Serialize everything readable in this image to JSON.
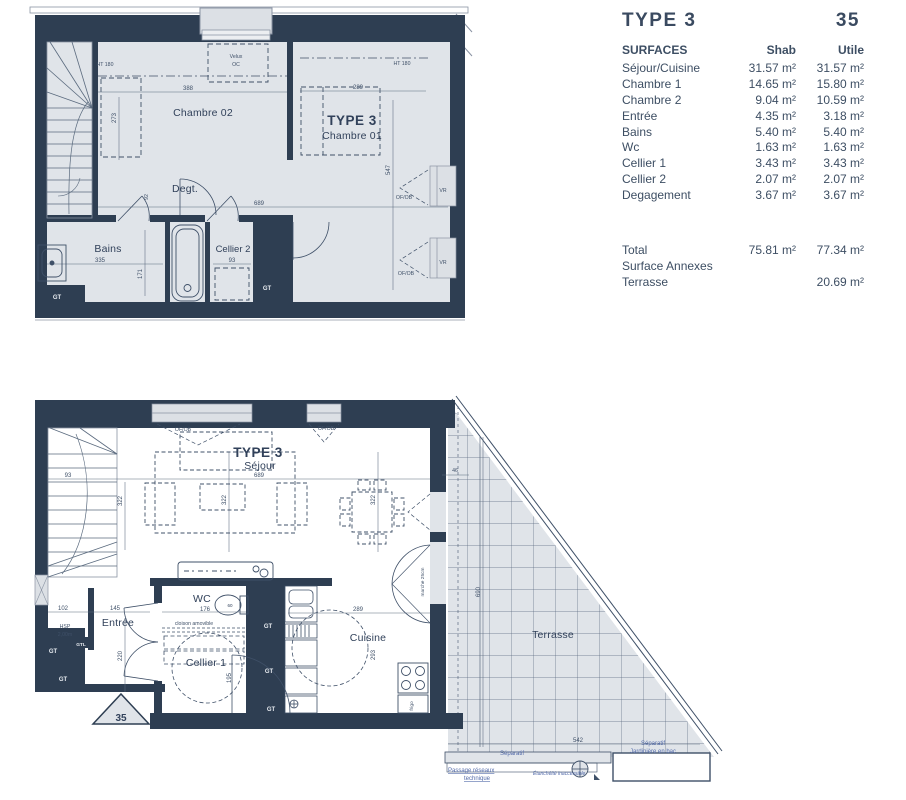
{
  "table": {
    "title": "TYPE 3",
    "unit_number": "35",
    "header": {
      "col1": "SURFACES",
      "col2": "Shab",
      "col3": "Utile"
    },
    "rows": [
      {
        "label": "Séjour/Cuisine",
        "shab": "31.57 m²",
        "utile": "31.57 m²"
      },
      {
        "label": "Chambre 1",
        "shab": "14.65 m²",
        "utile": "15.80 m²"
      },
      {
        "label": "Chambre 2",
        "shab": "9.04 m²",
        "utile": "10.59 m²"
      },
      {
        "label": "Entrée",
        "shab": "4.35 m²",
        "utile": "3.18 m²"
      },
      {
        "label": "Bains",
        "shab": "5.40 m²",
        "utile": "5.40 m²"
      },
      {
        "label": "Wc",
        "shab": "1.63 m²",
        "utile": "1.63 m²"
      },
      {
        "label": "Cellier 1",
        "shab": "3.43 m²",
        "utile": "3.43 m²"
      },
      {
        "label": "Cellier 2",
        "shab": "2.07 m²",
        "utile": "2.07 m²"
      },
      {
        "label": "Degagement",
        "shab": "3.67 m²",
        "utile": "3.67 m²"
      }
    ],
    "total": {
      "label": "Total",
      "shab": "75.81 m²",
      "utile": "77.34 m²"
    },
    "annexes_label": "Surface Annexes",
    "terrasse_row": {
      "label": "Terrasse",
      "utile": "20.69 m²"
    }
  },
  "upper_plan": {
    "rooms": {
      "chambre02": "Chambre 02",
      "type3": "TYPE 3",
      "chambre01": "Chambre 01",
      "degt": "Degt.",
      "bains": "Bains",
      "cellier2": "Cellier 2"
    },
    "labels": {
      "velux1": "Velux",
      "velux2": "OC",
      "ht180_left": "HT 180",
      "ht180_right": "HT 180",
      "vr1": "VR",
      "vr2": "VR",
      "ofob1": "OF/OB",
      "ofob2": "OF/OB",
      "gt1": "GT",
      "gt2": "GT"
    },
    "dims": {
      "d388": "388",
      "d273": "273",
      "d289": "289",
      "d547": "547",
      "d689": "689",
      "d92": "92",
      "d335": "335",
      "d171": "171",
      "d93": "93"
    }
  },
  "lower_plan": {
    "rooms": {
      "type3": "TYPE 3",
      "sejour": "Séjour",
      "entree": "Entrée",
      "wc": "WC",
      "cellier1": "Cellier 1",
      "cuisine": "Cuisine",
      "terrasse": "Terrasse"
    },
    "labels": {
      "ofob1": "OF/OB",
      "ofob2": "OF/OB",
      "hsp1": "HSP",
      "hsp2": "2,00m",
      "cloison": "cloison amovible",
      "gtl": "GTL",
      "gt_left1": "GT",
      "gt_left2": "GT",
      "gt_right1": "GT",
      "gt_right2": "GT",
      "gt_right3": "GT",
      "frigo": "frigo",
      "marche": "marche 25cm",
      "d60": "60",
      "triangle_number": "35",
      "separatif1": "Séparatif",
      "separatif2": "Séparatif",
      "jardiniere": "Jardinière en bac",
      "passage1": "Passage réseaux",
      "passage2": "technique",
      "etancheite": "Étanchéité inaccessible"
    },
    "dims": {
      "d93": "93",
      "d322a": "322",
      "d322b": "322",
      "d322c": "322",
      "d689": "689",
      "d46": "46",
      "d690": "690",
      "d102": "102",
      "d145": "145",
      "d220": "220",
      "d176": "176",
      "d195": "195",
      "d289": "289",
      "d293": "293",
      "d542": "542"
    }
  },
  "colors": {
    "wall": "#2e3e52",
    "floor": "#e0e4e9",
    "line": "#3f5068",
    "annotation_blue": "#5169a8",
    "table_text": "#3d4e63"
  }
}
